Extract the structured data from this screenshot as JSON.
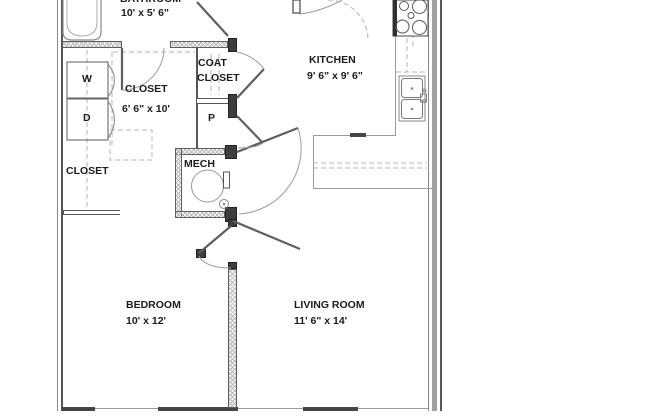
{
  "plan": {
    "rooms": {
      "bathroom": {
        "label": "BATHROOM",
        "dims": "10' x 5' 6\""
      },
      "kitchen": {
        "label": "KITCHEN",
        "dims": "9' 6\" x 9' 6\""
      },
      "coat_closet": {
        "label_line1": "COAT",
        "label_line2": "CLOSET"
      },
      "hall_closet": {
        "label": "CLOSET",
        "dims": "6' 6\" x 10'"
      },
      "bedroom_closet": {
        "label": "CLOSET"
      },
      "pantry": {
        "label": "P"
      },
      "mech": {
        "label": "MECH"
      },
      "bedroom": {
        "label": "BEDROOM",
        "dims": "10' x 12'"
      },
      "living_room": {
        "label": "LIVING ROOM",
        "dims": "11' 6\" x 14'"
      },
      "washer": {
        "label": "W"
      },
      "dryer": {
        "label": "D"
      }
    },
    "colors": {
      "wall_line": "#5e5e5e",
      "light_line": "#9a9a9a",
      "dark_fill": "#3d3d3d",
      "text": "#1c1c1c",
      "background": "#ffffff"
    }
  }
}
